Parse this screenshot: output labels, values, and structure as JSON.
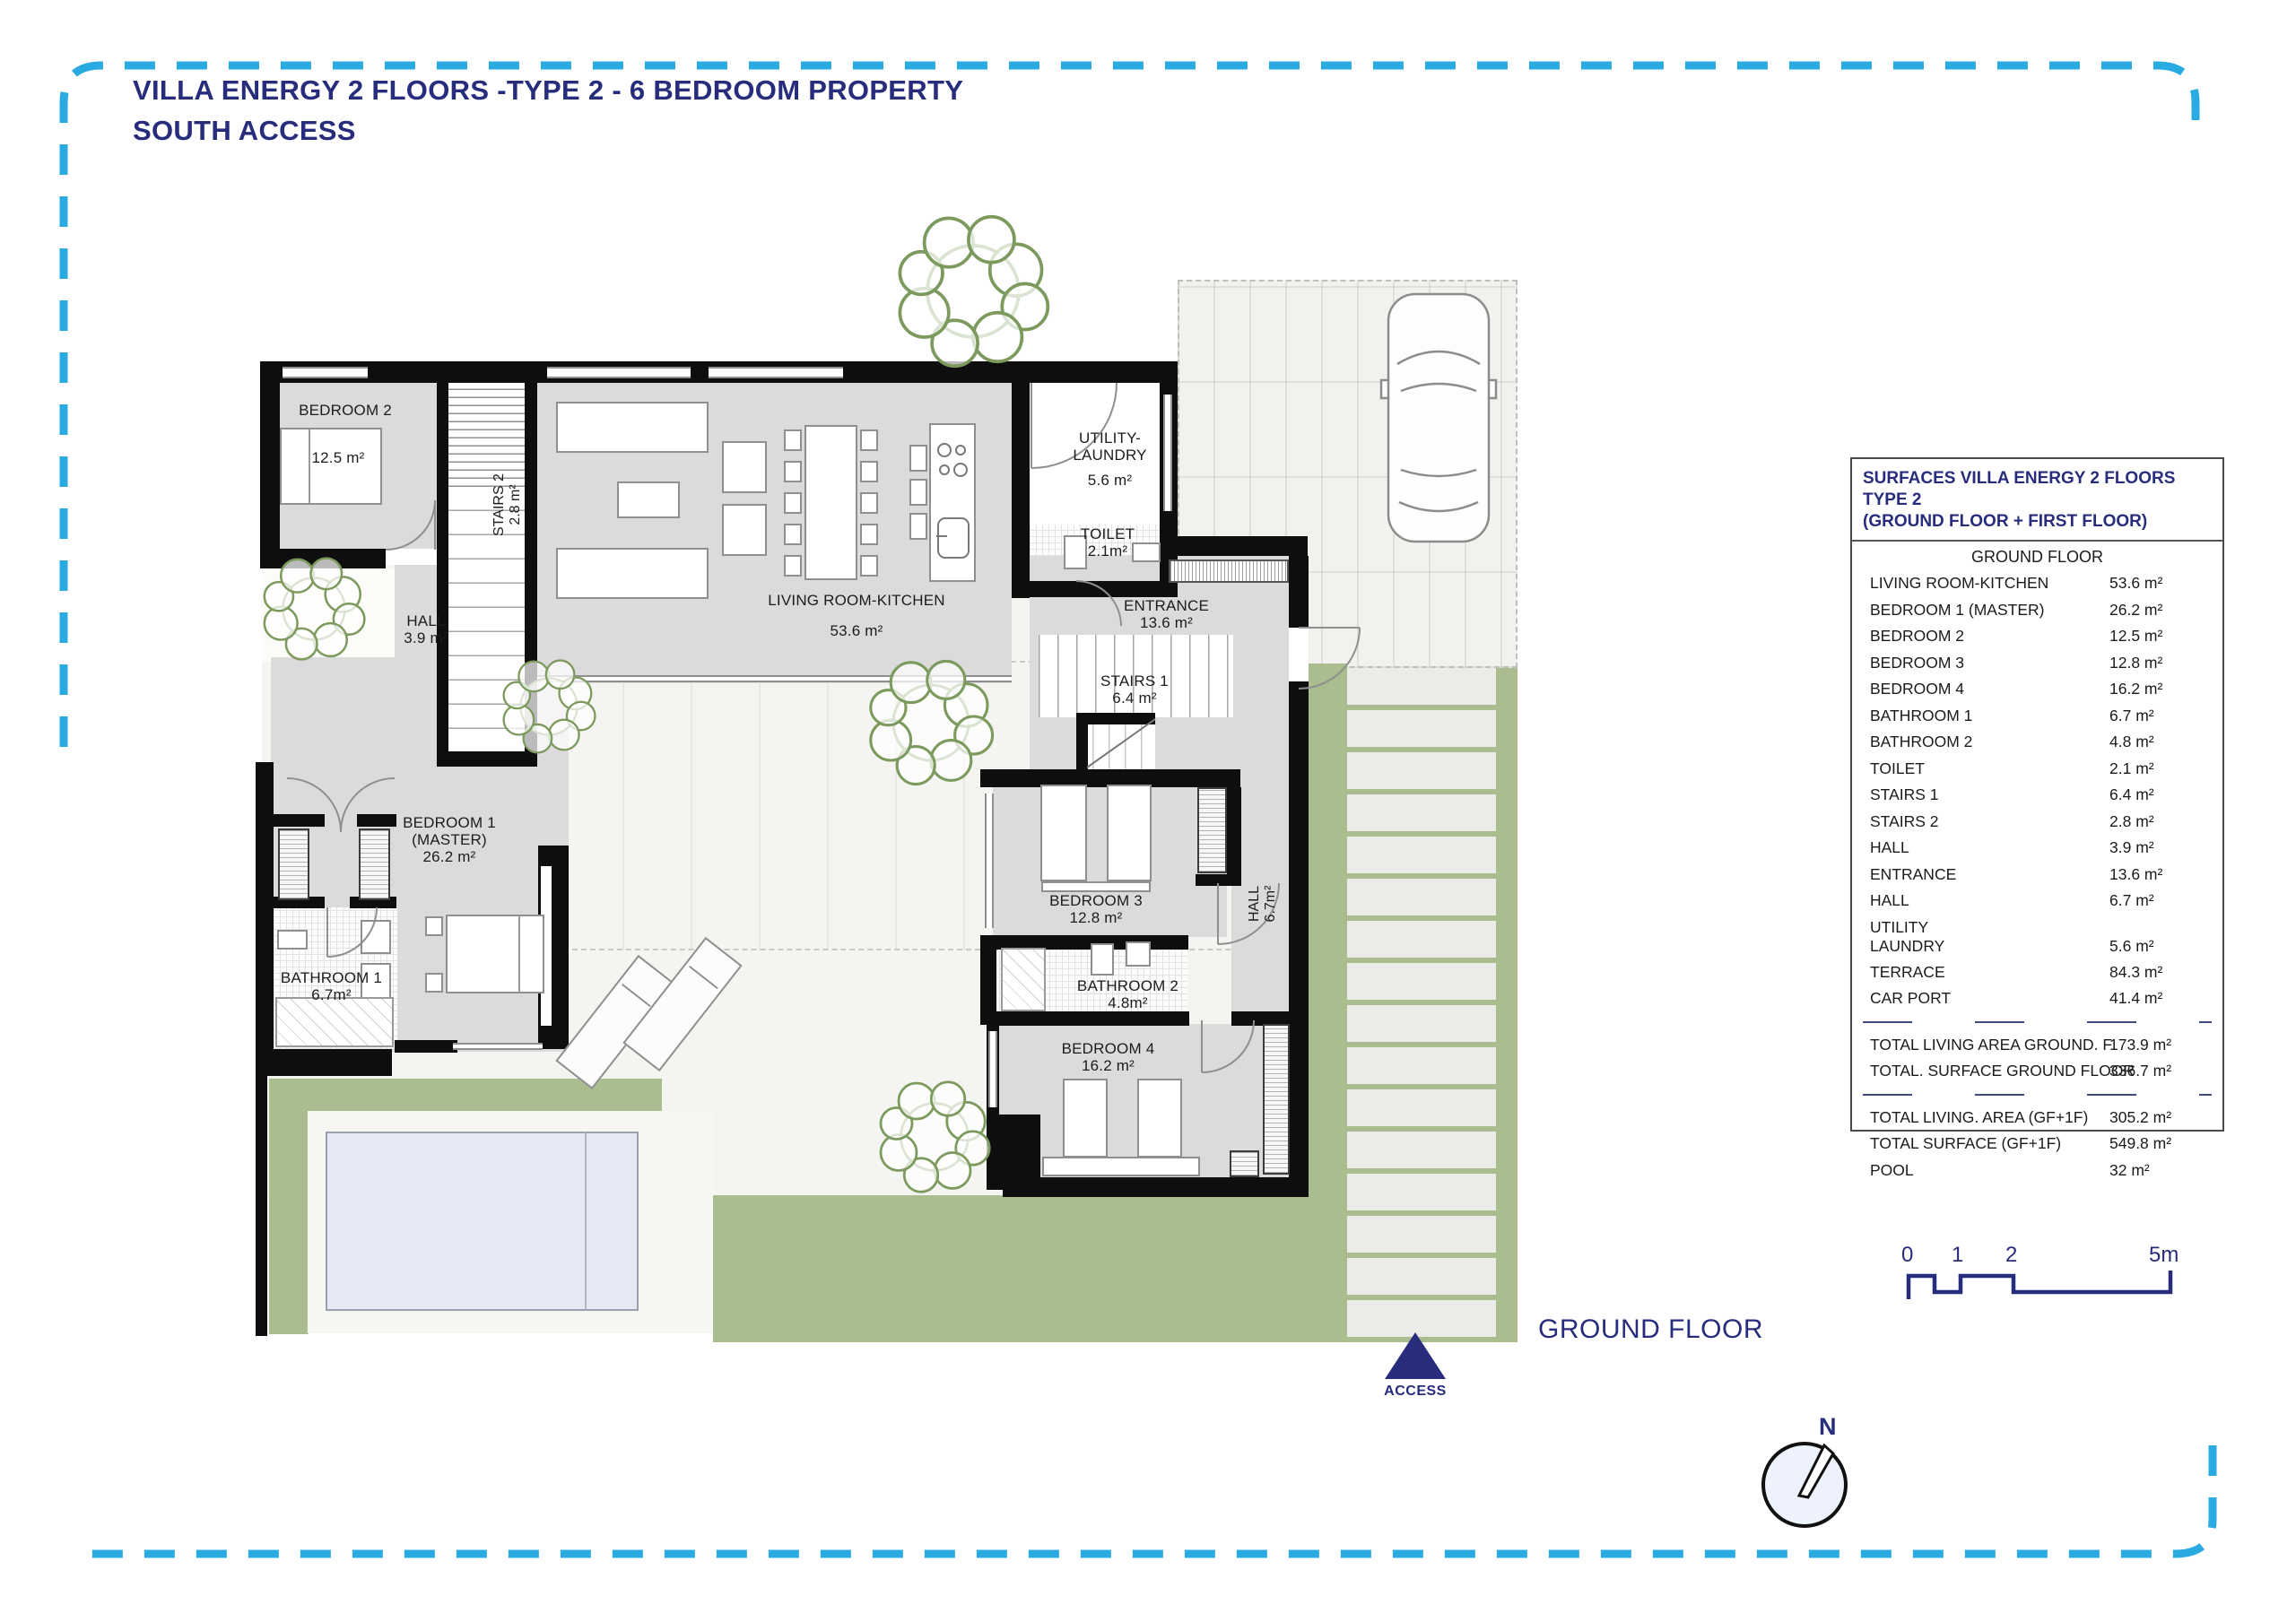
{
  "title": {
    "line1": "VILLA ENERGY 2 FLOORS -TYPE 2 - 6 BEDROOM PROPERTY",
    "line2": "SOUTH ACCESS"
  },
  "plan": {
    "floor_label": "GROUND FLOOR",
    "access_label": "ACCESS",
    "compass_n": "N",
    "rooms": {
      "bedroom2": {
        "name": "BEDROOM 2",
        "area": "12.5 m²"
      },
      "stairs2": {
        "name": "STAIRS 2",
        "area": "2.8 m²"
      },
      "hall1": {
        "name": "HALL",
        "area": "3.9 m²"
      },
      "living": {
        "name": "LIVING ROOM-KITCHEN",
        "area": "53.6 m²"
      },
      "utility": {
        "name": "UTILITY-",
        "name2": "LAUNDRY",
        "area": "5.6 m²"
      },
      "toilet": {
        "name": "TOILET",
        "area": "2.1m²"
      },
      "entrance": {
        "name": "ENTRANCE",
        "area": "13.6 m²"
      },
      "stairs1": {
        "name": "STAIRS 1",
        "area": "6.4 m²"
      },
      "bedroom1": {
        "name": "BEDROOM 1",
        "name2": "(MASTER)",
        "area": "26.2 m²"
      },
      "bathroom1": {
        "name": "BATHROOM 1",
        "area": "6.7m²"
      },
      "bedroom3": {
        "name": "BEDROOM 3",
        "area": "12.8 m²"
      },
      "hall2": {
        "name": "HALL",
        "area": "6.7m²"
      },
      "bathroom2": {
        "name": "BATHROOM 2",
        "area": "4.8m²"
      },
      "bedroom4": {
        "name": "BEDROOM 4",
        "area": "16.2 m²"
      }
    }
  },
  "surfaces_table": {
    "title_line1": "SURFACES VILLA ENERGY 2 FLOORS TYPE 2",
    "title_line2": "(GROUND FLOOR + FIRST FLOOR)",
    "section_header": "GROUND FLOOR",
    "rows": [
      {
        "label": "LIVING ROOM-KITCHEN",
        "value": "53.6 m²"
      },
      {
        "label": "BEDROOM 1 (MASTER)",
        "value": "26.2 m²"
      },
      {
        "label": "BEDROOM 2",
        "value": "12.5 m²"
      },
      {
        "label": "BEDROOM 3",
        "value": "12.8 m²"
      },
      {
        "label": "BEDROOM 4",
        "value": "16.2 m²"
      },
      {
        "label": "BATHROOM  1",
        "value": "6.7 m²"
      },
      {
        "label": "BATHROOM  2",
        "value": "4.8 m²"
      },
      {
        "label": "TOILET",
        "value": "2.1 m²"
      },
      {
        "label": "STAIRS 1",
        "value": "6.4 m²"
      },
      {
        "label": "STAIRS 2",
        "value": "2.8 m²"
      },
      {
        "label": "HALL",
        "value": "3.9 m²"
      },
      {
        "label": "ENTRANCE",
        "value": "13.6 m²"
      },
      {
        "label": "HALL",
        "value": "6.7 m²"
      },
      {
        "label": "UTILITY",
        "label2": "LAUNDRY",
        "value": "5.6 m²"
      },
      {
        "label": "TERRACE",
        "value": "84.3 m²"
      },
      {
        "label": "CAR PORT",
        "value": "41.4 m²"
      }
    ],
    "totals_ground": [
      {
        "label": "TOTAL LIVING AREA GROUND. F",
        "value": "173.9 m²"
      },
      {
        "label": "TOTAL. SURFACE  GROUND FLOOR",
        "value": "336.7 m²"
      }
    ],
    "totals_overall": [
      {
        "label": "TOTAL LIVING. AREA (GF+1F)",
        "value": "305.2 m²"
      },
      {
        "label": "TOTAL SURFACE (GF+1F)",
        "value": "549.8 m²"
      },
      {
        "label": "POOL",
        "value": "32 m²"
      }
    ]
  },
  "scale_bar": {
    "tick0": "0",
    "tick1": "1",
    "tick2": "2",
    "tick5": "5m"
  },
  "colors": {
    "accent_navy": "#272c7c",
    "frame_cyan": "#29abe2",
    "garden_green": "#a9bd8e"
  }
}
